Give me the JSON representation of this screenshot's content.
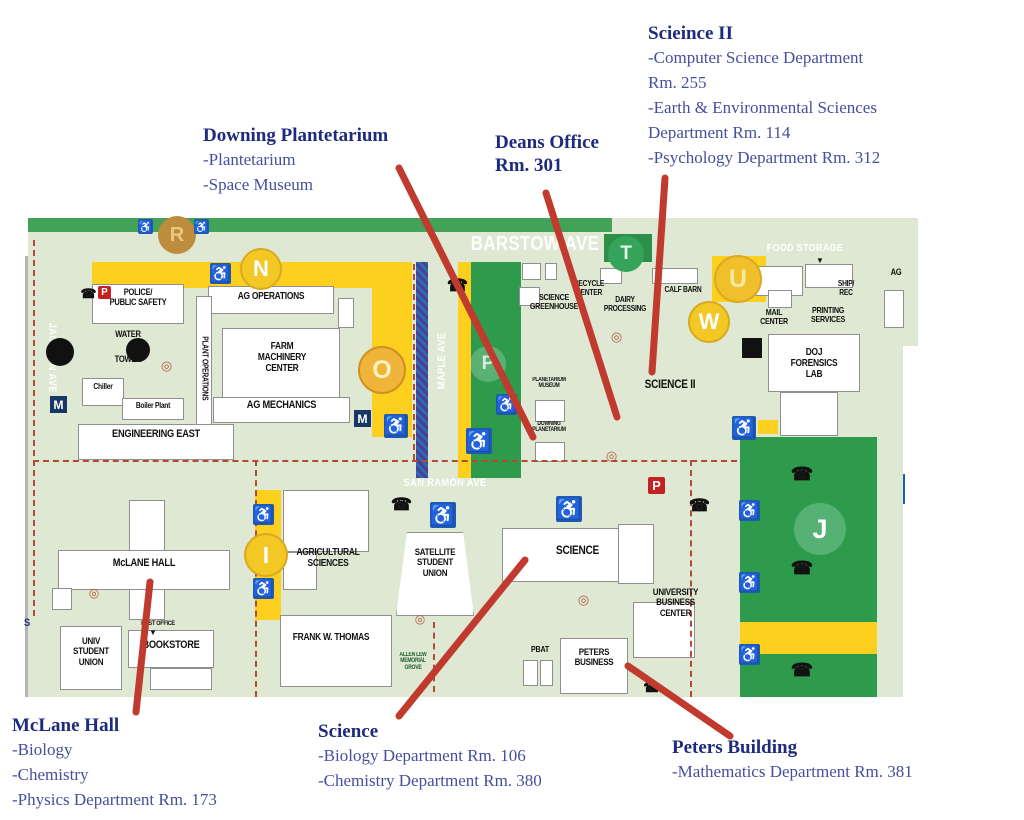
{
  "colors": {
    "road": "#1c5fae",
    "map_bg": "#dfe8d3",
    "strip_green": "#42a257",
    "lot_green": "#2e9a4c",
    "yellow": "#fdd01f",
    "red_line": "#c03a2e",
    "dash": "#b34a32",
    "callout_title": "#1e2a7e",
    "callout_text": "#454f9c",
    "access_blue": "#1e5bb0"
  },
  "callouts": [
    {
      "name": "science2",
      "title": "Scieince II",
      "lines": [
        "-Computer Science Department",
        "Rm. 255",
        "-Earth & Environmental Sciences",
        "Department Rm. 114",
        "-Psychology Department Rm. 312"
      ]
    },
    {
      "name": "downing",
      "title": "Downing Plantetarium",
      "lines": [
        "-Plantetarium",
        "-Space Museum"
      ]
    },
    {
      "name": "deans",
      "title": "Deans Office\nRm. 301",
      "lines": []
    },
    {
      "name": "mclane",
      "title": "McLane Hall",
      "lines": [
        "-Biology",
        "-Chemistry",
        "-Physics Department Rm. 173"
      ]
    },
    {
      "name": "science",
      "title": "Science",
      "lines": [
        "-Biology Department Rm. 106",
        "-Chemistry Department Rm. 380"
      ]
    },
    {
      "name": "peters",
      "title": "Peters Building",
      "lines": [
        "-Mathematics Department Rm. 381"
      ]
    }
  ],
  "pointer_lines": [
    {
      "name": "pointer-downing",
      "x1": 399,
      "y1": 168,
      "x2": 533,
      "y2": 437
    },
    {
      "name": "pointer-deans",
      "x1": 546,
      "y1": 193,
      "x2": 617,
      "y2": 417
    },
    {
      "name": "pointer-science2",
      "x1": 665,
      "y1": 178,
      "x2": 652,
      "y2": 372
    },
    {
      "name": "pointer-mclane",
      "x1": 150,
      "y1": 582,
      "x2": 136,
      "y2": 712
    },
    {
      "name": "pointer-science",
      "x1": 525,
      "y1": 560,
      "x2": 399,
      "y2": 716
    },
    {
      "name": "pointer-peters",
      "x1": 628,
      "y1": 666,
      "x2": 730,
      "y2": 736
    }
  ],
  "map": {
    "labels": [
      {
        "n": "label-police",
        "t": "POLICE/\nPUBLIC SAFETY",
        "x": 92,
        "y": 288,
        "w": 92,
        "fs": 9
      },
      {
        "n": "label-ag-operations",
        "t": "AG OPERATIONS",
        "x": 208,
        "y": 292,
        "w": 126,
        "fs": 10
      },
      {
        "n": "label-water",
        "t": "WATER",
        "x": 100,
        "y": 330,
        "w": 56,
        "fs": 9
      },
      {
        "n": "label-tower",
        "t": "TOWER",
        "x": 100,
        "y": 355,
        "w": 56,
        "fs": 9
      },
      {
        "n": "label-plant-operations",
        "t": "PLANT OPERATIONS",
        "x": 139,
        "y": 364,
        "w": 130,
        "fs": 8,
        "rot": 90
      },
      {
        "n": "label-farm-machinery-center",
        "t": "FARM\nMACHINERY\nCENTER",
        "x": 226,
        "y": 342,
        "w": 112,
        "fs": 10
      },
      {
        "n": "label-ag-mechanics",
        "t": "AG MECHANICS",
        "x": 213,
        "y": 400,
        "w": 137,
        "fs": 11
      },
      {
        "n": "label-chiller",
        "t": "Chiller",
        "x": 82,
        "y": 383,
        "w": 42,
        "fs": 8
      },
      {
        "n": "label-boiler-plant",
        "t": "Boiler Plant",
        "x": 122,
        "y": 402,
        "w": 62,
        "fs": 8
      },
      {
        "n": "label-engineering-east",
        "t": "ENGINEERING EAST",
        "x": 78,
        "y": 429,
        "w": 156,
        "fs": 11
      },
      {
        "n": "label-mclane-hall",
        "t": "McLANE HALL",
        "x": 58,
        "y": 558,
        "w": 172,
        "fs": 11
      },
      {
        "n": "label-univ-student-union",
        "t": "UNIV\nSTUDENT\nUNION",
        "x": 60,
        "y": 637,
        "w": 62,
        "fs": 9.5
      },
      {
        "n": "label-post-office",
        "t": "POST OFFICE",
        "x": 128,
        "y": 620,
        "w": 60,
        "fs": 6.5
      },
      {
        "n": "label-bookstore",
        "t": "BOOKSTORE",
        "x": 128,
        "y": 640,
        "w": 86,
        "fs": 11
      },
      {
        "n": "label-agricultural-sciences",
        "t": "AGRICULTURAL\nSCIENCES",
        "x": 283,
        "y": 548,
        "w": 90,
        "fs": 10
      },
      {
        "n": "label-satellite-student-union",
        "t": "SATELLITE\nSTUDENT\nUNION",
        "x": 400,
        "y": 548,
        "w": 70,
        "fs": 9.5
      },
      {
        "n": "label-frank-w-thomas",
        "t": "FRANK W. THOMAS",
        "x": 268,
        "y": 633,
        "w": 126,
        "fs": 10
      },
      {
        "n": "label-allen-lew-memorial-grove",
        "t": "ALLEN LEW\nMEMORIAL\nGROVE",
        "x": 390,
        "y": 652,
        "w": 46,
        "fs": 6,
        "c": "dgreen"
      },
      {
        "n": "label-science-building",
        "t": "SCIENCE",
        "x": 540,
        "y": 544,
        "w": 75,
        "fs": 12
      },
      {
        "n": "label-pbat",
        "t": "PBAT",
        "x": 520,
        "y": 645,
        "w": 40,
        "fs": 8.5
      },
      {
        "n": "label-peters-business",
        "t": "PETERS\nBUSINESS",
        "x": 560,
        "y": 648,
        "w": 68,
        "fs": 9.5
      },
      {
        "n": "label-university-business-center",
        "t": "UNIVERSITY\nBUSINESS\nCENTER",
        "x": 638,
        "y": 588,
        "w": 75,
        "fs": 9.5
      },
      {
        "n": "label-science-greenhouse",
        "t": "SCIENCE\nGREENHOUSE",
        "x": 518,
        "y": 293,
        "w": 72,
        "fs": 8.5
      },
      {
        "n": "label-recycle-center",
        "t": "RECYCLE\nCENTER",
        "x": 558,
        "y": 280,
        "w": 62,
        "fs": 8
      },
      {
        "n": "label-dairy-processing",
        "t": "DAIRY\nPROCESSING",
        "x": 596,
        "y": 296,
        "w": 58,
        "fs": 8
      },
      {
        "n": "label-calf-barn",
        "t": "CALF BARN",
        "x": 654,
        "y": 286,
        "w": 58,
        "fs": 8
      },
      {
        "n": "label-ship-rec",
        "t": "SHIP/\nREC",
        "x": 826,
        "y": 280,
        "w": 40,
        "fs": 8
      },
      {
        "n": "label-mail-center",
        "t": "MAIL\nCENTER",
        "x": 752,
        "y": 308,
        "w": 44,
        "fs": 8.5
      },
      {
        "n": "label-printing-services",
        "t": "PRINTING\nSERVICES",
        "x": 800,
        "y": 306,
        "w": 56,
        "fs": 8.5
      },
      {
        "n": "label-doj-forensics-lab",
        "t": "DOJ\nFORENSICS\nLAB",
        "x": 770,
        "y": 348,
        "w": 88,
        "fs": 10
      },
      {
        "n": "label-planetarium-museum",
        "t": "PLANETARIUM\nMUSEUM",
        "x": 518,
        "y": 377,
        "w": 62,
        "fs": 6
      },
      {
        "n": "label-downing-planetarium",
        "t": "DOWNING\nPLANETARIUM",
        "x": 518,
        "y": 421,
        "w": 62,
        "fs": 6
      },
      {
        "n": "label-science-ii",
        "t": "SCIENCE II",
        "x": 630,
        "y": 378,
        "w": 80,
        "fs": 12
      },
      {
        "n": "label-ag-clipped",
        "t": "AG",
        "x": 884,
        "y": 268,
        "w": 24,
        "fs": 9
      },
      {
        "n": "label-s-edge",
        "t": "S",
        "x": 20,
        "y": 618,
        "w": 14,
        "fs": 11,
        "c": "navy"
      },
      {
        "n": "label-barstow-ave",
        "t": "BARSTOW AVE",
        "x": 455,
        "y": 234,
        "w": 160,
        "fs": 20,
        "c": "white"
      },
      {
        "n": "label-food-storage",
        "t": "FOOD STORAGE",
        "x": 755,
        "y": 243,
        "w": 100,
        "fs": 10.5,
        "c": "white"
      },
      {
        "n": "label-san-ramon-ave",
        "t": "SAN RAMON AVE",
        "x": 390,
        "y": 478,
        "w": 110,
        "fs": 11,
        "c": "white"
      },
      {
        "n": "label-jackson-ave",
        "t": "JACKSON AVE",
        "x": -9,
        "y": 352,
        "w": 120,
        "fs": 11,
        "c": "white",
        "rot": 90
      },
      {
        "n": "label-maple-ave",
        "t": "MAPLE AVE",
        "x": 383,
        "y": 355,
        "w": 120,
        "fs": 11,
        "c": "white",
        "rot": -90
      }
    ],
    "circles": [
      {
        "n": "lot-circle-r",
        "t": "R",
        "x": 158,
        "y": 216,
        "d": 38,
        "bg": "#bd8c3c",
        "fg": "#e9c97f"
      },
      {
        "n": "lot-circle-n",
        "t": "N",
        "x": 240,
        "y": 248,
        "d": 42,
        "bg": "#f3c825",
        "fg": "#ffffff",
        "br": "#d9a923"
      },
      {
        "n": "lot-circle-o",
        "t": "O",
        "x": 358,
        "y": 346,
        "d": 48,
        "bg": "#efb53a",
        "fg": "#fdf3c0",
        "br": "#d09020"
      },
      {
        "n": "lot-circle-t",
        "t": "T",
        "x": 608,
        "y": 236,
        "d": 36,
        "bg": "#35a359",
        "fg": "#e8f5e9"
      },
      {
        "n": "lot-circle-u",
        "t": "U",
        "x": 714,
        "y": 255,
        "d": 48,
        "bg": "#f0c02a",
        "fg": "#f7e9a0",
        "br": "#d9a923"
      },
      {
        "n": "lot-circle-w",
        "t": "W",
        "x": 688,
        "y": 301,
        "d": 42,
        "bg": "#f3c825",
        "fg": "#ffffff",
        "br": "#d9a923"
      },
      {
        "n": "lot-circle-i",
        "t": "I",
        "x": 244,
        "y": 533,
        "d": 44,
        "bg": "#f3c825",
        "fg": "#ffffff",
        "br": "#d9a923"
      },
      {
        "n": "parking-p-faint",
        "t": "P",
        "x": 470,
        "y": 346,
        "d": 36,
        "bg": "rgba(255,255,255,0.22)",
        "fg": "rgba(255,255,255,0.75)"
      },
      {
        "n": "lot-circle-j",
        "t": "J",
        "x": 794,
        "y": 503,
        "d": 52,
        "bg": "#55b174",
        "fg": "#ffffff"
      }
    ],
    "icons": [
      {
        "k": "accessibility-icon",
        "g": "♿",
        "x": 138,
        "y": 219,
        "s": 15
      },
      {
        "k": "accessibility-icon",
        "g": "♿",
        "x": 194,
        "y": 219,
        "s": 15
      },
      {
        "k": "accessibility-icon",
        "g": "♿",
        "x": 210,
        "y": 263,
        "s": 21
      },
      {
        "k": "accessibility-icon",
        "g": "♿",
        "x": 384,
        "y": 414,
        "s": 24
      },
      {
        "k": "accessibility-icon",
        "g": "♿",
        "x": 496,
        "y": 394,
        "s": 21
      },
      {
        "k": "accessibility-icon",
        "g": "♿",
        "x": 466,
        "y": 428,
        "s": 26
      },
      {
        "k": "accessibility-icon",
        "g": "♿",
        "x": 430,
        "y": 502,
        "s": 26
      },
      {
        "k": "accessibility-icon",
        "g": "♿",
        "x": 556,
        "y": 496,
        "s": 26
      },
      {
        "k": "accessibility-icon",
        "g": "♿",
        "x": 732,
        "y": 416,
        "s": 24
      },
      {
        "k": "accessibility-icon",
        "g": "♿",
        "x": 739,
        "y": 500,
        "s": 21
      },
      {
        "k": "accessibility-icon",
        "g": "♿",
        "x": 739,
        "y": 572,
        "s": 21
      },
      {
        "k": "accessibility-icon",
        "g": "♿",
        "x": 739,
        "y": 644,
        "s": 21
      },
      {
        "k": "accessibility-icon",
        "g": "♿",
        "x": 253,
        "y": 504,
        "s": 21
      },
      {
        "k": "accessibility-icon",
        "g": "♿",
        "x": 253,
        "y": 578,
        "s": 21
      },
      {
        "k": "phone-icon",
        "g": "☎",
        "x": 82,
        "y": 287,
        "s": 13
      },
      {
        "k": "phone-icon",
        "g": "☎",
        "x": 449,
        "y": 277,
        "s": 17
      },
      {
        "k": "phone-icon",
        "g": "☎",
        "x": 393,
        "y": 496,
        "s": 17
      },
      {
        "k": "phone-icon",
        "g": "☎",
        "x": 691,
        "y": 497,
        "s": 17
      },
      {
        "k": "phone-icon",
        "g": "☎",
        "x": 793,
        "y": 465,
        "s": 18
      },
      {
        "k": "phone-icon",
        "g": "☎",
        "x": 793,
        "y": 559,
        "s": 18
      },
      {
        "k": "phone-icon",
        "g": "☎",
        "x": 793,
        "y": 661,
        "s": 18
      },
      {
        "k": "phone-icon",
        "g": "☎",
        "x": 645,
        "y": 680,
        "s": 14
      },
      {
        "k": "target-icon",
        "g": "◎",
        "x": 160,
        "y": 359,
        "s": 13
      },
      {
        "k": "target-icon",
        "g": "◎",
        "x": 610,
        "y": 330,
        "s": 13
      },
      {
        "k": "target-icon",
        "g": "◎",
        "x": 605,
        "y": 449,
        "s": 13
      },
      {
        "k": "target-icon",
        "g": "◎",
        "x": 577,
        "y": 593,
        "s": 13
      },
      {
        "k": "target-icon",
        "g": "◎",
        "x": 414,
        "y": 613,
        "s": 12
      },
      {
        "k": "target-icon",
        "g": "◎",
        "x": 88,
        "y": 587,
        "s": 12
      },
      {
        "k": "metro-icon",
        "g": "M",
        "x": 50,
        "y": 396,
        "s": 17
      },
      {
        "k": "metro-icon",
        "g": "M",
        "x": 354,
        "y": 410,
        "s": 17
      },
      {
        "k": "parking-sign-icon",
        "g": "P",
        "x": 648,
        "y": 477,
        "s": 17
      },
      {
        "k": "parking-sign-icon",
        "g": "P",
        "x": 98,
        "y": 286,
        "s": 13
      },
      {
        "k": "black-dot",
        "g": "",
        "x": 46,
        "y": 338,
        "s": 28
      },
      {
        "k": "black-dot",
        "g": "",
        "x": 126,
        "y": 338,
        "s": 24
      },
      {
        "k": "black-square",
        "g": "",
        "x": 742,
        "y": 338,
        "s": 20
      },
      {
        "k": "arrow-down-icon",
        "g": "▼",
        "x": 816,
        "y": 256,
        "s": 8
      },
      {
        "k": "arrow-down-icon",
        "g": "▼",
        "x": 149,
        "y": 628,
        "s": 8
      }
    ]
  }
}
